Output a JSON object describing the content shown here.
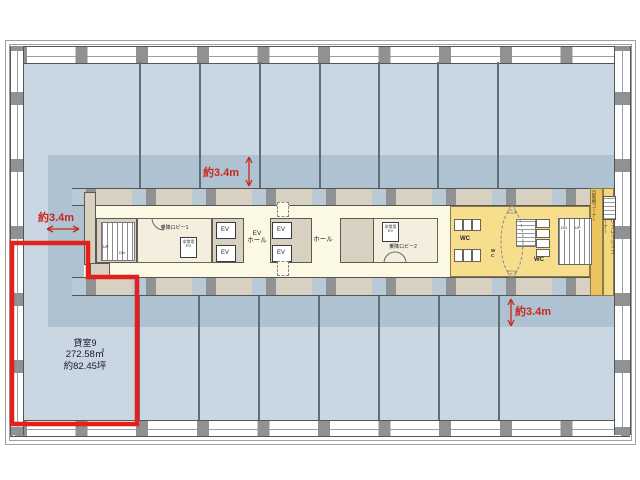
{
  "room": {
    "name": "貸室9",
    "area_sqm": "272.58㎡",
    "area_tsubo": "約82.45坪"
  },
  "dimensions": {
    "top": "約3.4m",
    "left": "約3.4m",
    "bottom": "約3.4m"
  },
  "core": {
    "lobby1": "乗降ロビー1",
    "lobby2": "乗降ロビー2",
    "emergency_ev_line1": "非常用",
    "emergency_ev_line2": "EV",
    "ev": "EV",
    "ev_hall_line1": "EV",
    "ev_hall_line2": "ホール",
    "hall": "ホール",
    "wc": "WC",
    "vending_corner": "自販機コーナー",
    "refresh_corner": "リフレッシュコーナー",
    "up": "UP",
    "dn": "DN"
  },
  "colors": {
    "floor_blue": "#c9d7e2",
    "zone_blue": "#aec2d1",
    "core_cream": "#fbf8e3",
    "wall_tan": "#d8d0c1",
    "wc_yellow": "#f6de8c",
    "vending_ochre": "#ebc45f",
    "refresh_ochre": "#f4d77e",
    "outline_red": "#e2211c"
  }
}
